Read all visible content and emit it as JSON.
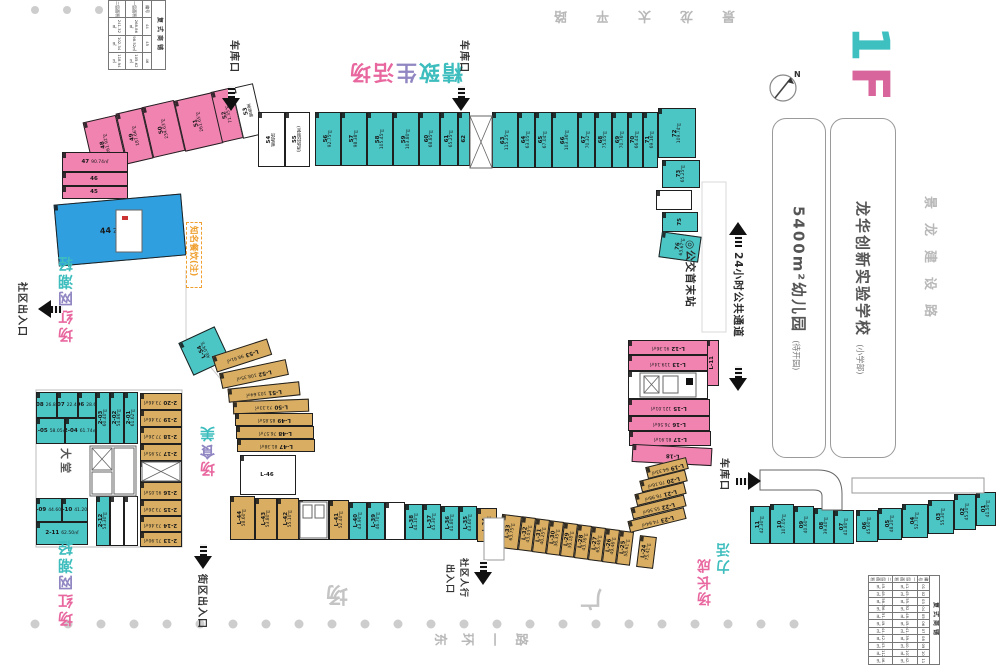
{
  "floor": {
    "label": "1F",
    "color_one": "#3fc0c0",
    "color_f": "#d8659b"
  },
  "compass": {
    "label": "N"
  },
  "roads": {
    "top": "景龙太平路",
    "right": "景龙建设路",
    "bottom": "东环一路",
    "plaza_right": "广",
    "plaza_left": "场"
  },
  "landmarks": {
    "school": {
      "name": "龙华创新实验学校",
      "note": "(小学部)"
    },
    "kindergarten": {
      "name": "5400m²幼儿园",
      "note": "(待开园)"
    }
  },
  "zones": {
    "boutique": {
      "text": "精致生活场",
      "colors": [
        "#3dbdbd",
        "#3dbdbd",
        "#8f86c2",
        "#e8679f",
        "#e8679f"
      ]
    },
    "trendy_top": {
      "text": "轻潮网红场",
      "colors": [
        "#3dbdbd",
        "#3dbdbd",
        "#8f86c2",
        "#e8679f",
        "#e8679f"
      ]
    },
    "trendy_bottom": {
      "text": "轻潮网红场",
      "colors": [
        "#3dbdbd",
        "#3dbdbd",
        "#8f86c2",
        "#e8679f",
        "#e8679f"
      ]
    },
    "food": {
      "text": "美食场",
      "colors": [
        "#3dbdbd",
        "#8f86c2",
        "#e8679f"
      ]
    },
    "vitality_a": {
      "text": "活力",
      "colors": [
        "#3dbdbd",
        "#3dbdbd"
      ]
    },
    "vitality_b": {
      "text": "成长场",
      "colors": [
        "#e8679f",
        "#e8679f",
        "#e8679f"
      ]
    }
  },
  "entrances": {
    "garage": "车库口",
    "community": "社区出入口",
    "street": "街区出入口",
    "pedestrian_l1": "社区人行",
    "pedestrian_l2": "出入口"
  },
  "transit": {
    "bus": "◎公交首末站",
    "passage": "24小时公共通道"
  },
  "callout": {
    "text": "知名餐饮(注)"
  },
  "lobby": {
    "label": "大堂"
  },
  "units": [
    {
      "id": "48",
      "a": "261.92㎡",
      "x": 88,
      "y": 118,
      "w": 34,
      "h": 52,
      "c": "pink",
      "r": -13,
      "lr": "v"
    },
    {
      "id": "49",
      "a": "187.66㎡",
      "x": 121,
      "y": 110,
      "w": 27,
      "h": 52,
      "c": "pink",
      "r": -13,
      "lr": "v"
    },
    {
      "id": "50",
      "a": "234.63㎡",
      "x": 147,
      "y": 103,
      "w": 33,
      "h": 52,
      "c": "pink",
      "r": -13,
      "lr": "v"
    },
    {
      "id": "51",
      "a": "261.65㎡",
      "x": 179,
      "y": 96,
      "w": 39,
      "h": 52,
      "c": "pink",
      "r": -13,
      "lr": "v"
    },
    {
      "id": "52",
      "a": "71.35㎡",
      "x": 216,
      "y": 89,
      "w": 22,
      "h": 52,
      "c": "pink",
      "r": -13,
      "lr": "v"
    },
    {
      "id": "53",
      "a": "警务室",
      "x": 237,
      "y": 85,
      "w": 22,
      "h": 52,
      "c": "white",
      "r": -13,
      "lr": "v"
    },
    {
      "id": "47",
      "a": "90.74㎡",
      "x": 62,
      "y": 152,
      "w": 66,
      "h": 20,
      "c": "pink"
    },
    {
      "id": "46",
      "a": "",
      "x": 62,
      "y": 172,
      "w": 66,
      "h": 14,
      "c": "pink"
    },
    {
      "id": "45",
      "a": "",
      "x": 62,
      "y": 186,
      "w": 66,
      "h": 13,
      "c": "pink"
    },
    {
      "id": "44",
      "a": "268.86㎡",
      "x": 56,
      "y": 199,
      "w": 128,
      "h": 62,
      "c": "blue",
      "r": -5,
      "big": 1
    },
    {
      "id": "54",
      "a": "邮政所",
      "x": 258,
      "y": 112,
      "w": 27,
      "h": 55,
      "c": "white",
      "lr": "v"
    },
    {
      "id": "55",
      "a": "(消防控制室)",
      "x": 285,
      "y": 112,
      "w": 25,
      "h": 55,
      "c": "white",
      "lr": "v"
    },
    {
      "id": "56",
      "a": "92.75㎡",
      "x": 315,
      "y": 112,
      "w": 26,
      "h": 54,
      "c": "teal",
      "lr": "v"
    },
    {
      "id": "57",
      "a": "98.38㎡",
      "x": 341,
      "y": 112,
      "w": 26,
      "h": 54,
      "c": "teal",
      "lr": "v"
    },
    {
      "id": "58",
      "a": "105.45㎡",
      "x": 367,
      "y": 112,
      "w": 26,
      "h": 54,
      "c": "teal",
      "lr": "v"
    },
    {
      "id": "59",
      "a": "103.80㎡",
      "x": 393,
      "y": 112,
      "w": 26,
      "h": 54,
      "c": "teal",
      "lr": "v"
    },
    {
      "id": "60",
      "a": "68.85㎡",
      "x": 419,
      "y": 112,
      "w": 21,
      "h": 54,
      "c": "teal",
      "lr": "v"
    },
    {
      "id": "61",
      "a": "65.25㎡",
      "x": 440,
      "y": 112,
      "w": 18,
      "h": 54,
      "c": "teal",
      "lr": "v"
    },
    {
      "id": "62",
      "a": "",
      "x": 458,
      "y": 112,
      "w": 12,
      "h": 54,
      "c": "teal",
      "lr": "v"
    },
    {
      "id": "63",
      "a": "115.25㎡",
      "x": 492,
      "y": 112,
      "w": 26,
      "h": 56,
      "c": "teal",
      "lr": "v"
    },
    {
      "id": "64",
      "a": "63.05㎡",
      "x": 518,
      "y": 112,
      "w": 17,
      "h": 56,
      "c": "teal",
      "lr": "v"
    },
    {
      "id": "65",
      "a": "67.04㎡",
      "x": 535,
      "y": 112,
      "w": 17,
      "h": 56,
      "c": "teal",
      "lr": "v"
    },
    {
      "id": "66",
      "a": "103.36㎡",
      "x": 552,
      "y": 112,
      "w": 26,
      "h": 56,
      "c": "teal",
      "lr": "v"
    },
    {
      "id": "67",
      "a": "70.32㎡",
      "x": 578,
      "y": 112,
      "w": 17,
      "h": 56,
      "c": "teal",
      "lr": "v"
    },
    {
      "id": "68",
      "a": "75.05㎡",
      "x": 595,
      "y": 112,
      "w": 17,
      "h": 56,
      "c": "teal",
      "lr": "v"
    },
    {
      "id": "69",
      "a": "70.76㎡",
      "x": 612,
      "y": 112,
      "w": 16,
      "h": 56,
      "c": "teal",
      "lr": "v"
    },
    {
      "id": "70",
      "a": "66.44㎡",
      "x": 628,
      "y": 112,
      "w": 15,
      "h": 56,
      "c": "teal",
      "lr": "v"
    },
    {
      "id": "71",
      "a": "69.16㎡",
      "x": 643,
      "y": 112,
      "w": 15,
      "h": 56,
      "c": "teal",
      "lr": "v"
    },
    {
      "id": "72",
      "a": "109.74㎡",
      "x": 658,
      "y": 108,
      "w": 38,
      "h": 50,
      "c": "teal",
      "lr": "v"
    },
    {
      "id": "73",
      "a": "65.25㎡",
      "x": 662,
      "y": 160,
      "w": 38,
      "h": 28,
      "c": "teal",
      "lr": "v"
    },
    {
      "id": "",
      "a": "",
      "x": 656,
      "y": 190,
      "w": 36,
      "h": 20,
      "c": "white"
    },
    {
      "id": "75",
      "a": "",
      "x": 662,
      "y": 212,
      "w": 36,
      "h": 20,
      "c": "teal",
      "lr": "v"
    },
    {
      "id": "76",
      "a": "63.67㎡",
      "x": 660,
      "y": 234,
      "w": 40,
      "h": 26,
      "c": "teal",
      "r": 8,
      "lr": "v"
    },
    {
      "id": "L-11",
      "a": "",
      "x": 706,
      "y": 340,
      "w": 13,
      "h": 46,
      "c": "pink",
      "lr": "v"
    },
    {
      "id": "L-12",
      "a": "91.36㎡",
      "x": 628,
      "y": 340,
      "w": 80,
      "h": 15,
      "c": "pink",
      "lr": "180"
    },
    {
      "id": "L-13",
      "a": "119.14㎡",
      "x": 628,
      "y": 355,
      "w": 80,
      "h": 16,
      "c": "pink",
      "lr": "180"
    },
    {
      "id": "",
      "a": "",
      "x": 628,
      "y": 371,
      "w": 80,
      "h": 28,
      "c": "white"
    },
    {
      "id": "L-15",
      "a": "121.01㎡",
      "x": 628,
      "y": 399,
      "w": 82,
      "h": 17,
      "c": "pink",
      "lr": "180"
    },
    {
      "id": "L-16",
      "a": "76.56㎡",
      "x": 628,
      "y": 416,
      "w": 82,
      "h": 15,
      "c": "pink",
      "lr": "180"
    },
    {
      "id": "L-17",
      "a": "81.91㎡",
      "x": 629,
      "y": 431,
      "w": 82,
      "h": 15,
      "c": "pink",
      "lr": "180"
    },
    {
      "id": "L-18",
      "a": "",
      "x": 632,
      "y": 446,
      "w": 80,
      "h": 18,
      "c": "pink",
      "r": 3,
      "lr": "180"
    },
    {
      "id": "L-19",
      "a": "64.33㎡",
      "x": 646,
      "y": 462,
      "w": 42,
      "h": 12,
      "c": "tan",
      "r": -14,
      "lr": "180"
    },
    {
      "id": "L-20",
      "a": "70.16㎡",
      "x": 640,
      "y": 475,
      "w": 47,
      "h": 12,
      "c": "tan",
      "r": -14,
      "lr": "180"
    },
    {
      "id": "L-21",
      "a": "76.98㎡",
      "x": 635,
      "y": 488,
      "w": 51,
      "h": 12,
      "c": "tan",
      "r": -14,
      "lr": "180"
    },
    {
      "id": "L-22",
      "a": "55.56㎡",
      "x": 631,
      "y": 501,
      "w": 55,
      "h": 12,
      "c": "tan",
      "r": -14,
      "lr": "180"
    },
    {
      "id": "L-23",
      "a": "74.64㎡",
      "x": 628,
      "y": 514,
      "w": 58,
      "h": 12,
      "c": "tan",
      "r": -14,
      "lr": "180"
    },
    {
      "id": "L-24",
      "a": "75.41㎡",
      "x": 638,
      "y": 536,
      "w": 17,
      "h": 32,
      "c": "tan",
      "r": 7,
      "lr": "v"
    },
    {
      "id": "L-25",
      "a": "58.61㎡",
      "x": 618,
      "y": 531,
      "w": 14,
      "h": 34,
      "c": "tan",
      "r": 7,
      "lr": "v"
    },
    {
      "id": "L-26",
      "a": "49.46㎡",
      "x": 604,
      "y": 529,
      "w": 14,
      "h": 34,
      "c": "tan",
      "r": 7,
      "lr": "v"
    },
    {
      "id": "L-27",
      "a": "65.46㎡",
      "x": 590,
      "y": 527,
      "w": 14,
      "h": 34,
      "c": "tan",
      "r": 7,
      "lr": "v"
    },
    {
      "id": "L-28",
      "a": "43.76㎡",
      "x": 576,
      "y": 525,
      "w": 14,
      "h": 34,
      "c": "tan",
      "r": 7,
      "lr": "v"
    },
    {
      "id": "L-29",
      "a": "39.18㎡",
      "x": 562,
      "y": 523,
      "w": 14,
      "h": 34,
      "c": "tan",
      "r": 7,
      "lr": "v"
    },
    {
      "id": "L-30",
      "a": "36.35㎡",
      "x": 548,
      "y": 521,
      "w": 14,
      "h": 34,
      "c": "tan",
      "r": 7,
      "lr": "v"
    },
    {
      "id": "L-31",
      "a": "40.25㎡",
      "x": 534,
      "y": 519,
      "w": 14,
      "h": 34,
      "c": "tan",
      "r": 7,
      "lr": "v"
    },
    {
      "id": "L-32",
      "a": "43.03㎡",
      "x": 520,
      "y": 517,
      "w": 14,
      "h": 34,
      "c": "tan",
      "r": 7,
      "lr": "v"
    },
    {
      "id": "L-33",
      "a": "63.75㎡",
      "x": 500,
      "y": 515,
      "w": 20,
      "h": 34,
      "c": "tan",
      "r": 7,
      "lr": "v"
    },
    {
      "id": "L-34",
      "a": "48.20㎡",
      "x": 477,
      "y": 508,
      "w": 20,
      "h": 34,
      "c": "tan",
      "lr": "v"
    },
    {
      "id": "L-35",
      "a": "43.60㎡",
      "x": 459,
      "y": 506,
      "w": 18,
      "h": 34,
      "c": "teal",
      "lr": "v"
    },
    {
      "id": "L-36",
      "a": "41.80㎡",
      "x": 441,
      "y": 506,
      "w": 18,
      "h": 34,
      "c": "teal",
      "lr": "v"
    },
    {
      "id": "L-37",
      "a": "45.30㎡",
      "x": 423,
      "y": 504,
      "w": 18,
      "h": 36,
      "c": "teal",
      "lr": "v"
    },
    {
      "id": "L-38",
      "a": "44.10㎡",
      "x": 405,
      "y": 504,
      "w": 18,
      "h": 36,
      "c": "teal",
      "lr": "v"
    },
    {
      "id": "",
      "a": "",
      "x": 385,
      "y": 502,
      "w": 20,
      "h": 38,
      "c": "white"
    },
    {
      "id": "L-39",
      "a": "46.70㎡",
      "x": 367,
      "y": 502,
      "w": 18,
      "h": 38,
      "c": "teal",
      "lr": "v"
    },
    {
      "id": "L-40",
      "a": "43.90㎡",
      "x": 349,
      "y": 502,
      "w": 18,
      "h": 38,
      "c": "teal",
      "lr": "v"
    },
    {
      "id": "L-41",
      "a": "52.40㎡",
      "x": 329,
      "y": 500,
      "w": 20,
      "h": 40,
      "c": "tan",
      "lr": "v"
    },
    {
      "id": "",
      "a": "",
      "x": 299,
      "y": 500,
      "w": 30,
      "h": 40,
      "c": "white"
    },
    {
      "id": "L-42",
      "a": "55.10㎡",
      "x": 277,
      "y": 498,
      "w": 22,
      "h": 42,
      "c": "tan",
      "lr": "v"
    },
    {
      "id": "L-43",
      "a": "53.80㎡",
      "x": 255,
      "y": 498,
      "w": 22,
      "h": 42,
      "c": "tan",
      "lr": "v"
    },
    {
      "id": "L-44",
      "a": "58.60㎡",
      "x": 230,
      "y": 496,
      "w": 25,
      "h": 44,
      "c": "tan",
      "lr": "v"
    },
    {
      "id": "L-54",
      "a": "46.04㎡",
      "x": 184,
      "y": 333,
      "w": 40,
      "h": 36,
      "c": "teal",
      "r": -25,
      "lr": "v"
    },
    {
      "id": "L-53",
      "a": "98.91㎡",
      "x": 213,
      "y": 347,
      "w": 58,
      "h": 17,
      "c": "tan",
      "r": -18,
      "lr": "180"
    },
    {
      "id": "L-52",
      "a": "108.35㎡",
      "x": 220,
      "y": 366,
      "w": 68,
      "h": 16,
      "c": "tan",
      "r": -12,
      "lr": "180"
    },
    {
      "id": "L-51",
      "a": "103.64㎡",
      "x": 228,
      "y": 385,
      "w": 72,
      "h": 14,
      "c": "tan",
      "r": -6,
      "lr": "180"
    },
    {
      "id": "L-50",
      "a": "73.33㎡",
      "x": 233,
      "y": 400,
      "w": 76,
      "h": 13,
      "c": "tan",
      "r": -2,
      "lr": "180"
    },
    {
      "id": "L-49",
      "a": "85.85㎡",
      "x": 235,
      "y": 413,
      "w": 78,
      "h": 13,
      "c": "tan",
      "lr": "180"
    },
    {
      "id": "L-48",
      "a": "76.57㎡",
      "x": 236,
      "y": 426,
      "w": 78,
      "h": 13,
      "c": "tan",
      "lr": "180"
    },
    {
      "id": "L-47",
      "a": "81.38㎡",
      "x": 237,
      "y": 439,
      "w": 78,
      "h": 13,
      "c": "tan",
      "lr": "180"
    },
    {
      "id": "L-46",
      "a": "",
      "x": 240,
      "y": 455,
      "w": 56,
      "h": 40,
      "c": "white"
    },
    {
      "id": "2-20",
      "a": "73.46㎡",
      "x": 140,
      "y": 393,
      "w": 42,
      "h": 17,
      "c": "tan",
      "lr": "180"
    },
    {
      "id": "2-19",
      "a": "73.46㎡",
      "x": 140,
      "y": 410,
      "w": 42,
      "h": 17,
      "c": "tan",
      "lr": "180"
    },
    {
      "id": "2-18",
      "a": "77.26㎡",
      "x": 140,
      "y": 427,
      "w": 42,
      "h": 17,
      "c": "tan",
      "lr": "180"
    },
    {
      "id": "2-17",
      "a": "75.95㎡",
      "x": 140,
      "y": 444,
      "w": 42,
      "h": 17,
      "c": "tan",
      "lr": "180"
    },
    {
      "id": "",
      "a": "",
      "x": 140,
      "y": 461,
      "w": 42,
      "h": 21,
      "c": "white"
    },
    {
      "id": "2-16",
      "a": "91.05㎡",
      "x": 140,
      "y": 482,
      "w": 42,
      "h": 18,
      "c": "tan",
      "lr": "180"
    },
    {
      "id": "2-15",
      "a": "73.26㎡",
      "x": 140,
      "y": 500,
      "w": 42,
      "h": 16,
      "c": "tan",
      "lr": "180"
    },
    {
      "id": "2-14",
      "a": "73.46㎡",
      "x": 140,
      "y": 516,
      "w": 42,
      "h": 16,
      "c": "tan",
      "lr": "180"
    },
    {
      "id": "2-13",
      "a": "71.90㎡",
      "x": 140,
      "y": 532,
      "w": 42,
      "h": 15,
      "c": "tan",
      "lr": "180"
    },
    {
      "id": "2-08",
      "a": "26.84㎡",
      "x": 36,
      "y": 392,
      "w": 21,
      "h": 26,
      "c": "teal"
    },
    {
      "id": "2-07",
      "a": "22.40㎡",
      "x": 57,
      "y": 392,
      "w": 21,
      "h": 26,
      "c": "teal"
    },
    {
      "id": "2-06",
      "a": "28.62㎡",
      "x": 78,
      "y": 392,
      "w": 18,
      "h": 26,
      "c": "teal"
    },
    {
      "id": "2-05",
      "a": "58.05㎡",
      "x": 36,
      "y": 418,
      "w": 29,
      "h": 26,
      "c": "teal"
    },
    {
      "id": "2-04",
      "a": "61.74㎡",
      "x": 65,
      "y": 418,
      "w": 31,
      "h": 26,
      "c": "teal"
    },
    {
      "id": "2-03",
      "a": "60.40㎡",
      "x": 96,
      "y": 392,
      "w": 14,
      "h": 52,
      "c": "teal",
      "lr": "v"
    },
    {
      "id": "2-02",
      "a": "54.86㎡",
      "x": 110,
      "y": 392,
      "w": 14,
      "h": 52,
      "c": "teal",
      "lr": "v"
    },
    {
      "id": "2-01",
      "a": "61.62㎡",
      "x": 124,
      "y": 392,
      "w": 14,
      "h": 52,
      "c": "teal",
      "lr": "v"
    },
    {
      "id": "2-09",
      "a": "44.60㎡",
      "x": 36,
      "y": 498,
      "w": 26,
      "h": 24,
      "c": "teal"
    },
    {
      "id": "2-10",
      "a": "41.20㎡",
      "x": 62,
      "y": 498,
      "w": 26,
      "h": 24,
      "c": "teal"
    },
    {
      "id": "2-11",
      "a": "62.50㎡",
      "x": 36,
      "y": 522,
      "w": 52,
      "h": 23,
      "c": "teal"
    },
    {
      "id": "2-12",
      "a": "53.30㎡",
      "x": 96,
      "y": 496,
      "w": 14,
      "h": 50,
      "c": "teal",
      "lr": "v"
    },
    {
      "id": "",
      "a": "",
      "x": 110,
      "y": 496,
      "w": 14,
      "h": 50,
      "c": "white"
    },
    {
      "id": "",
      "a": "",
      "x": 124,
      "y": 496,
      "w": 14,
      "h": 50,
      "c": "white"
    },
    {
      "id": "11",
      "a": "42.30㎡",
      "x": 750,
      "y": 506,
      "w": 20,
      "h": 38,
      "c": "teal",
      "lr": "v"
    },
    {
      "id": "10",
      "a": "107.05㎡",
      "x": 770,
      "y": 504,
      "w": 24,
      "h": 40,
      "c": "teal",
      "lr": "v"
    },
    {
      "id": "09",
      "a": "40.60㎡",
      "x": 794,
      "y": 506,
      "w": 20,
      "h": 38,
      "c": "teal",
      "lr": "v"
    },
    {
      "id": "08",
      "a": "39.40㎡",
      "x": 814,
      "y": 508,
      "w": 20,
      "h": 36,
      "c": "teal",
      "lr": "v"
    },
    {
      "id": "07",
      "a": "41.80㎡",
      "x": 834,
      "y": 510,
      "w": 20,
      "h": 34,
      "c": "teal",
      "lr": "v"
    },
    {
      "id": "06",
      "a": "45.60㎡",
      "x": 856,
      "y": 510,
      "w": 22,
      "h": 32,
      "c": "teal",
      "lr": "v"
    },
    {
      "id": "05",
      "a": "48.20㎡",
      "x": 878,
      "y": 508,
      "w": 24,
      "h": 32,
      "c": "teal",
      "lr": "v"
    },
    {
      "id": "04",
      "a": "52.70㎡",
      "x": 902,
      "y": 504,
      "w": 26,
      "h": 34,
      "c": "teal",
      "lr": "v"
    },
    {
      "id": "03",
      "a": "55.30㎡",
      "x": 928,
      "y": 500,
      "w": 26,
      "h": 34,
      "c": "teal",
      "lr": "v"
    },
    {
      "id": "02",
      "a": "45.20㎡",
      "x": 954,
      "y": 494,
      "w": 22,
      "h": 36,
      "c": "teal",
      "lr": "v"
    },
    {
      "id": "01",
      "a": "41.50㎡",
      "x": 976,
      "y": 492,
      "w": 20,
      "h": 34,
      "c": "teal",
      "lr": "v"
    }
  ],
  "tables": {
    "small": {
      "title": "复式商铺",
      "headers": [
        "编号",
        "一层面积",
        "二层面积"
      ],
      "rows": [
        [
          "44",
          "268.86㎡",
          "241.32㎡"
        ],
        [
          "45",
          "98.52㎡",
          "102.34㎡"
        ],
        [
          "46",
          "105.62㎡",
          "118.94㎡"
        ]
      ]
    },
    "large": {
      "title": "复式商铺",
      "headers": [
        "编号",
        "一层面积",
        "二层面积"
      ],
      "rows": [
        [
          "01",
          "41.50㎡",
          "45.36㎡"
        ],
        [
          "02",
          "45.20㎡",
          "48.12㎡"
        ],
        [
          "03",
          "55.30㎡",
          "58.24㎡"
        ],
        [
          "04",
          "52.70㎡",
          "56.08㎡"
        ],
        [
          "05",
          "48.20㎡",
          "51.33㎡"
        ],
        [
          "06",
          "45.60㎡",
          "49.75㎡"
        ],
        [
          "07",
          "41.80㎡",
          "44.91㎡"
        ],
        [
          "08",
          "39.40㎡",
          "42.37㎡"
        ],
        [
          "09",
          "40.60㎡",
          "43.58㎡"
        ],
        [
          "10",
          "107.05㎡",
          "112.46㎡"
        ],
        [
          "11",
          "42.30㎡",
          "46.23㎡"
        ]
      ]
    }
  }
}
